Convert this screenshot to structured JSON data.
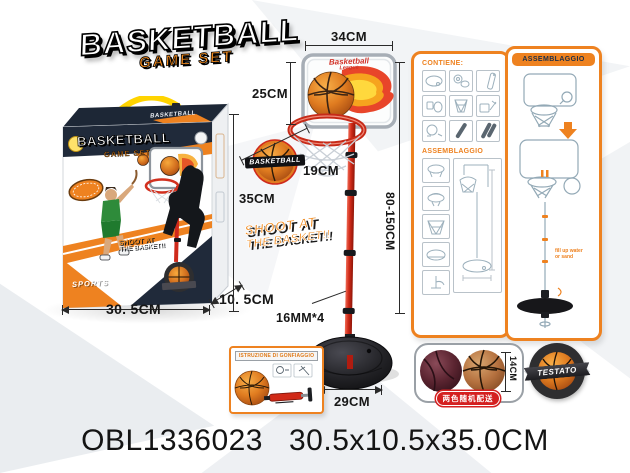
{
  "logo": {
    "title": "BASKETBALL",
    "subtitle": "GAME SET"
  },
  "box": {
    "top_label": "BASKETBALL",
    "brand_title": "BASKETBALL",
    "brand_subtitle": "GAME SET",
    "shoot_line1": "SHOOT AT",
    "shoot_line2": "THE BASKET!!",
    "sports_label": "SPORTS"
  },
  "dims": {
    "backboard_width": "34CM",
    "backboard_height": "25CM",
    "hoop_diameter": "19CM",
    "box_height": "35CM",
    "pole_height": "80-150CM",
    "pole_tube": "16MM*4",
    "base_width": "29CM",
    "box_width": "30. 5CM",
    "box_depth": "10. 5CM",
    "ball_diameter": "14CM"
  },
  "stand": {
    "script_line1": "Basketball",
    "script_line2": "League",
    "badge_label": "BASKETBALL",
    "shoot_line1": "SHOOT AT",
    "shoot_line2": "THE BASKET!!"
  },
  "inset": {
    "title": "ISTRUZIONE DI GONFIAGGIO"
  },
  "panel_contiene": {
    "title": "CONTIENE:",
    "section2": "ASSEMBLAGGIO"
  },
  "panel_assembly": {
    "title": "ASSEMBLAGGIO",
    "note1": "fill up water",
    "note2": "or sand"
  },
  "balls": {
    "note": "两色随机配送"
  },
  "badge": {
    "label": "TESTATO"
  },
  "footer": {
    "code": "OBL1336023",
    "size": "30.5x10.5x35.0CM"
  },
  "colors": {
    "accent": "#ee8220",
    "navy": "#202a3a",
    "red": "#cf2a1c"
  }
}
